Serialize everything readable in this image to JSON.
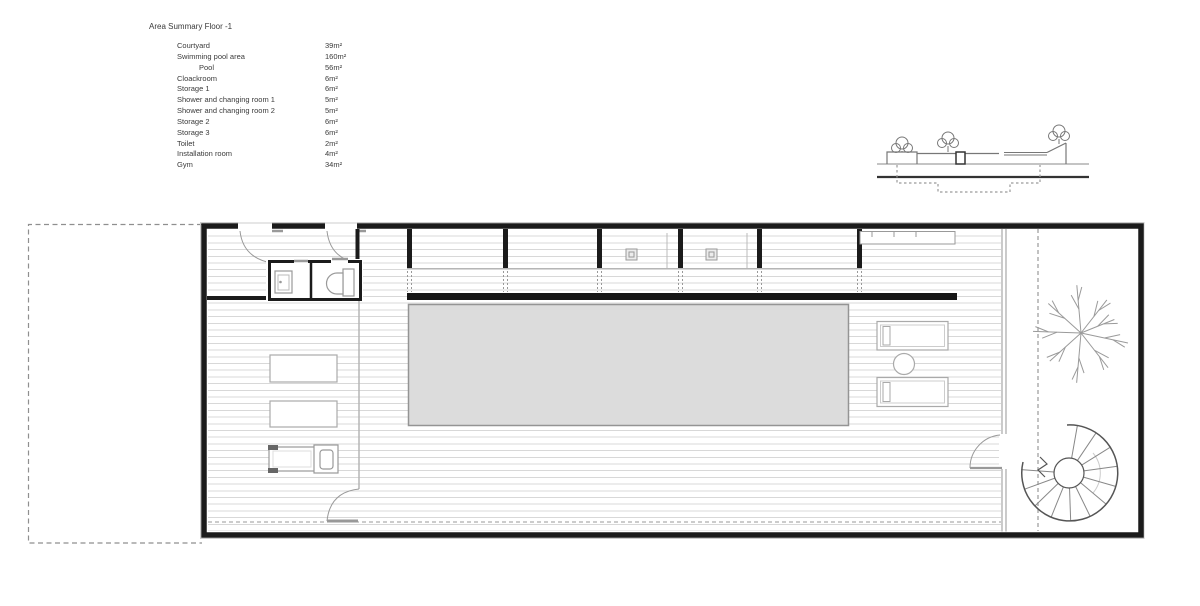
{
  "area_summary": {
    "title": "Area Summary Floor -1",
    "items": [
      {
        "label": "Courtyard",
        "value": "39m²",
        "indent": false
      },
      {
        "label": "Swimming pool area",
        "value": "160m²",
        "indent": false
      },
      {
        "label": "Pool",
        "value": "56m²",
        "indent": true
      },
      {
        "label": "Cloackroom",
        "value": "6m²",
        "indent": false
      },
      {
        "label": "Storage 1",
        "value": "6m²",
        "indent": false
      },
      {
        "label": "Shower and changing room 1",
        "value": "5m²",
        "indent": false
      },
      {
        "label": "Shower and changing room 2",
        "value": "5m²",
        "indent": false
      },
      {
        "label": "Storage 2",
        "value": "6m²",
        "indent": false
      },
      {
        "label": "Storage 3",
        "value": "6m²",
        "indent": false
      },
      {
        "label": "Toilet",
        "value": "2m²",
        "indent": false
      },
      {
        "label": "Installation room",
        "value": "4m²",
        "indent": false
      },
      {
        "label": "Gym",
        "value": "34m²",
        "indent": false
      }
    ]
  },
  "colors": {
    "pool_fill": "#dcdcdc",
    "wall": "#1b1b1b",
    "deck_line": "#d8d8d8",
    "dashed_line": "#999999"
  }
}
